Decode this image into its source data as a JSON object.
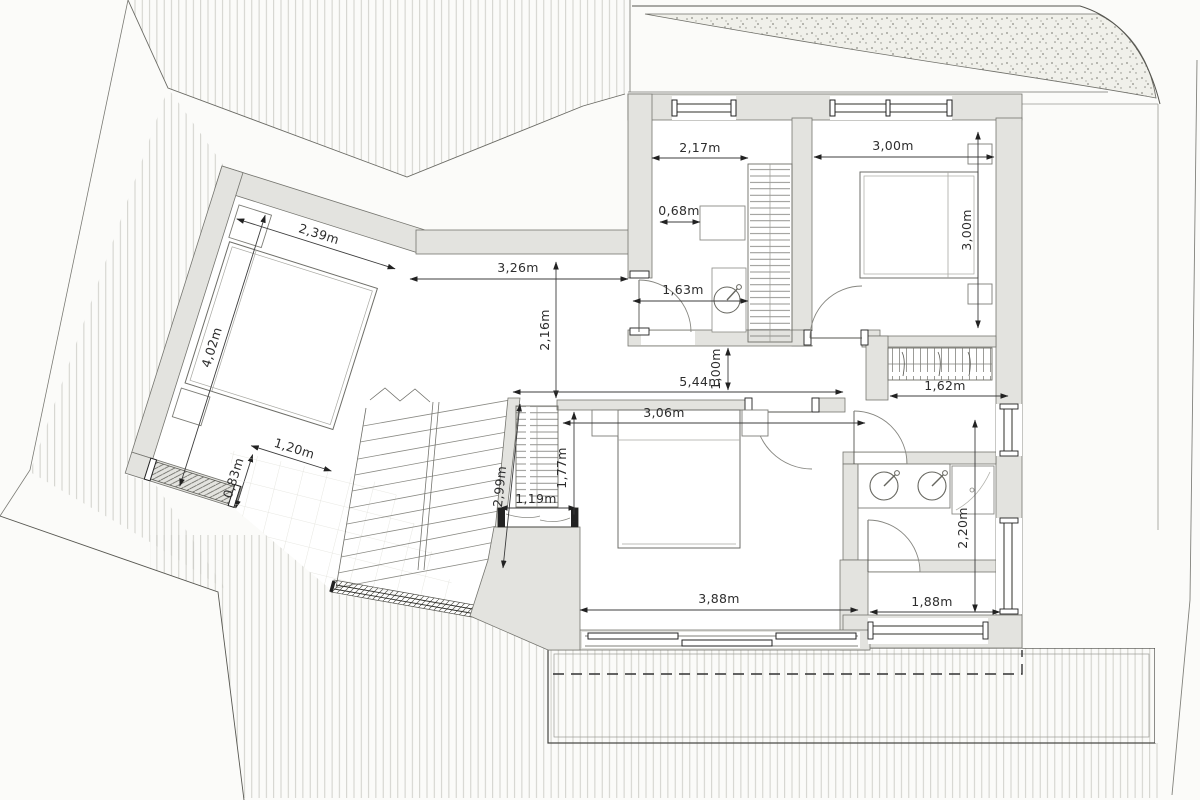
{
  "drawing": {
    "type": "floor-plan",
    "unit_suffix": "m",
    "colors": {
      "wall_fill": "#e3e3df",
      "wall_edge": "#75756f",
      "hatch_line": "#cbcbc5",
      "dimension_text": "#2d2d2d",
      "boundary_line": "#6a6a64",
      "gravel_speckle": "#8d8d85",
      "paper": "#fbfbf9"
    }
  },
  "dims": {
    "w_2_17": "2,17m",
    "w_3_00": "3,00m",
    "h_3_00": "3,00m",
    "w_0_68": "0,68m",
    "w_1_63": "1,63m",
    "w_3_26": "3,26m",
    "h_2_16": "2,16m",
    "w_5_44": "5,44m",
    "h_1_00": "1,00m",
    "w_2_39": "2,39m",
    "h_4_02": "4,02m",
    "w_1_20": "1,20m",
    "h_0_83": "0,83m",
    "h_2_99": "2,99m",
    "w_1_19": "1,19m",
    "h_1_77": "1,77m",
    "w_3_06": "3,06m",
    "w_1_62": "1,62m",
    "h_2_20": "2,20m",
    "w_1_88": "1,88m",
    "w_3_88": "3,88m"
  }
}
